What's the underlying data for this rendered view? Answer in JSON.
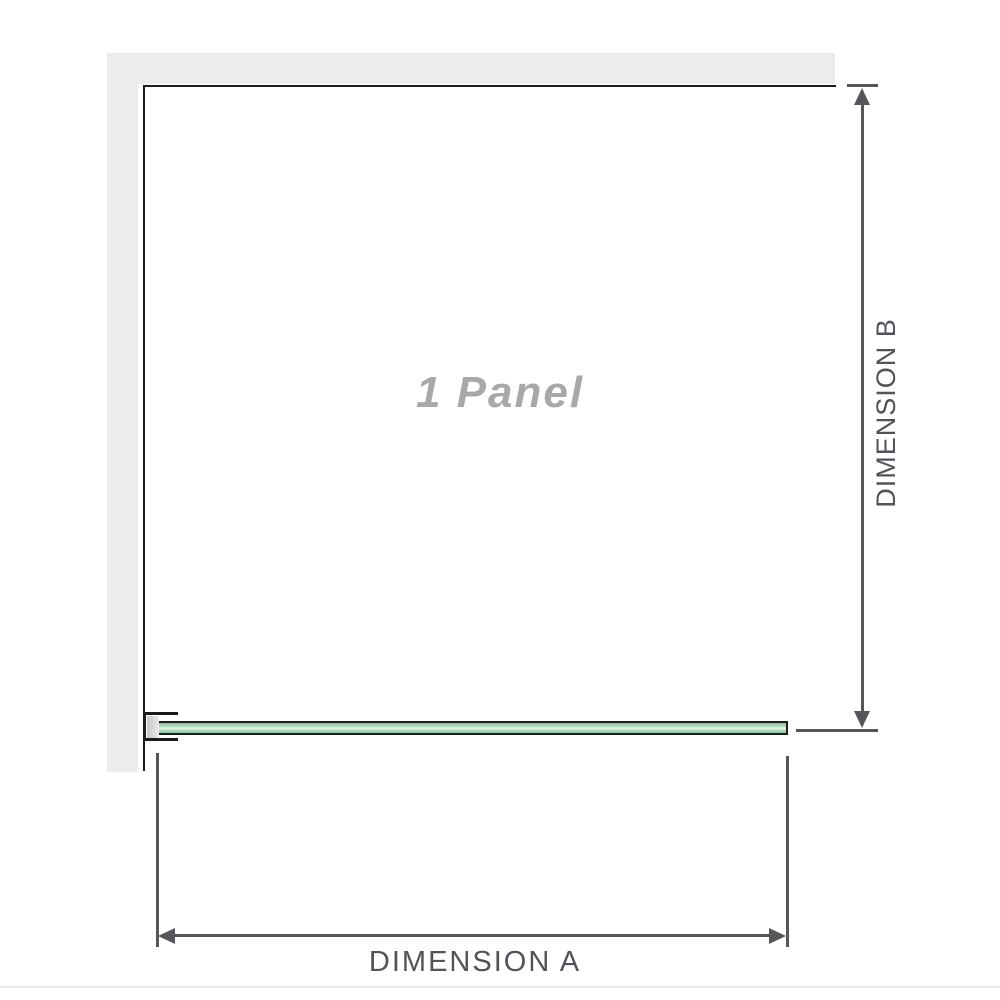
{
  "diagram": {
    "panel_label": "1 Panel",
    "dimension_a_label": "DIMENSION A",
    "dimension_b_label": "DIMENSION B"
  },
  "colors": {
    "wall": "#ececec",
    "panel_border": "#1b1b1b",
    "glass_border": "#1e1e1e",
    "glass_top": "#7fc191",
    "glass_light": "#ebf7ec",
    "glass_bottom": "#8cc89c",
    "bracket_pad_dark": "#c6c6c6",
    "bracket_pad_light": "#ebebeb",
    "dim": "#55565a",
    "dim_text": "#515358",
    "panel_text": "#a8a8a8",
    "separator": "#e9e9e6"
  }
}
